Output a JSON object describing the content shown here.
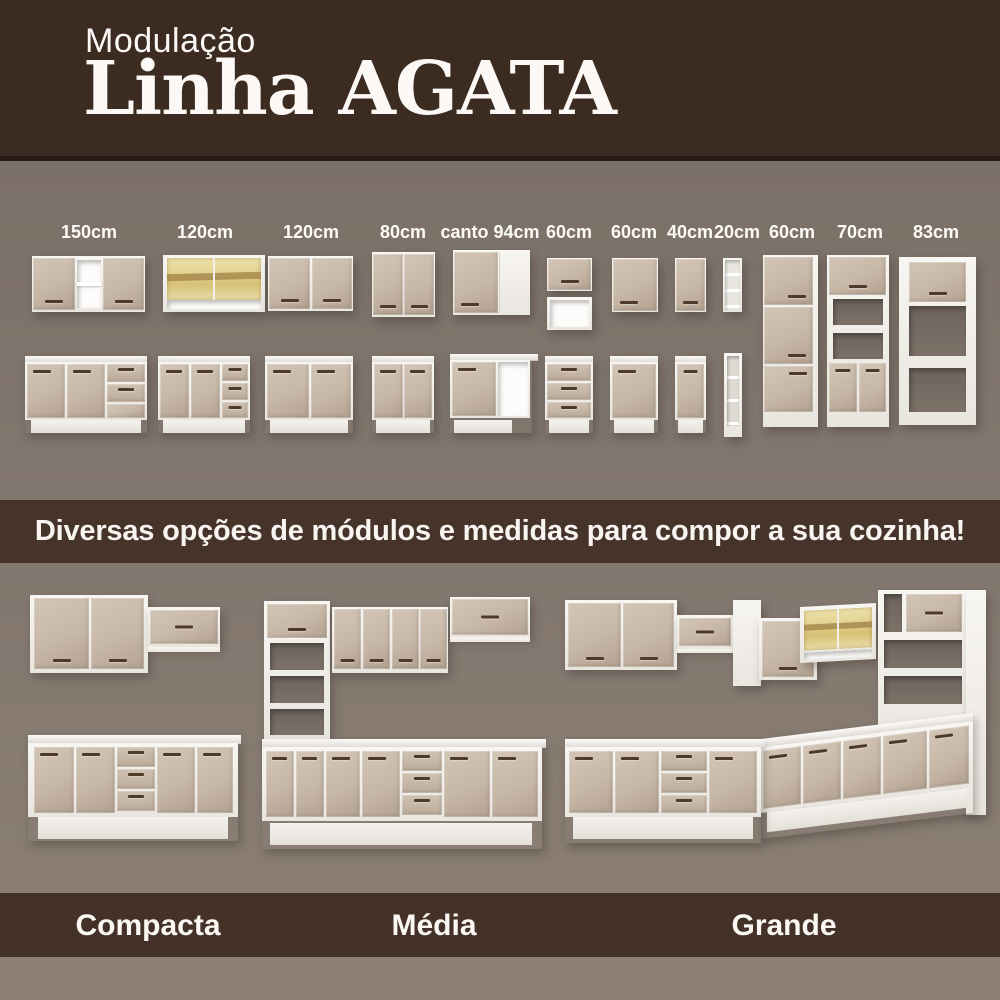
{
  "header": {
    "eyebrow": "Modulação",
    "title": "Linha AGATA"
  },
  "modules": {
    "sizes": [
      "150cm",
      "120cm",
      "120cm",
      "80cm",
      "canto 94cm",
      "60cm",
      "60cm",
      "40cm",
      "20cm",
      "60cm",
      "70cm",
      "83cm"
    ]
  },
  "banner": {
    "text": "Diversas opções de módulos e medidas para compor a sua cozinha!"
  },
  "kitchens": {
    "labels": [
      "Compacta",
      "Média",
      "Grande"
    ]
  },
  "colors": {
    "header_brown": "#3b2b21",
    "band_brown": "#46332a",
    "section_background": "#7c7168",
    "bottom_strip": "#8c8076",
    "door_taupe": "#c8b8a8",
    "handle_brown": "#4d3a2b",
    "carcass_white": "#f6f4f0",
    "glass_amber": "#e7d89b",
    "countertop": "#e9e6e0"
  }
}
